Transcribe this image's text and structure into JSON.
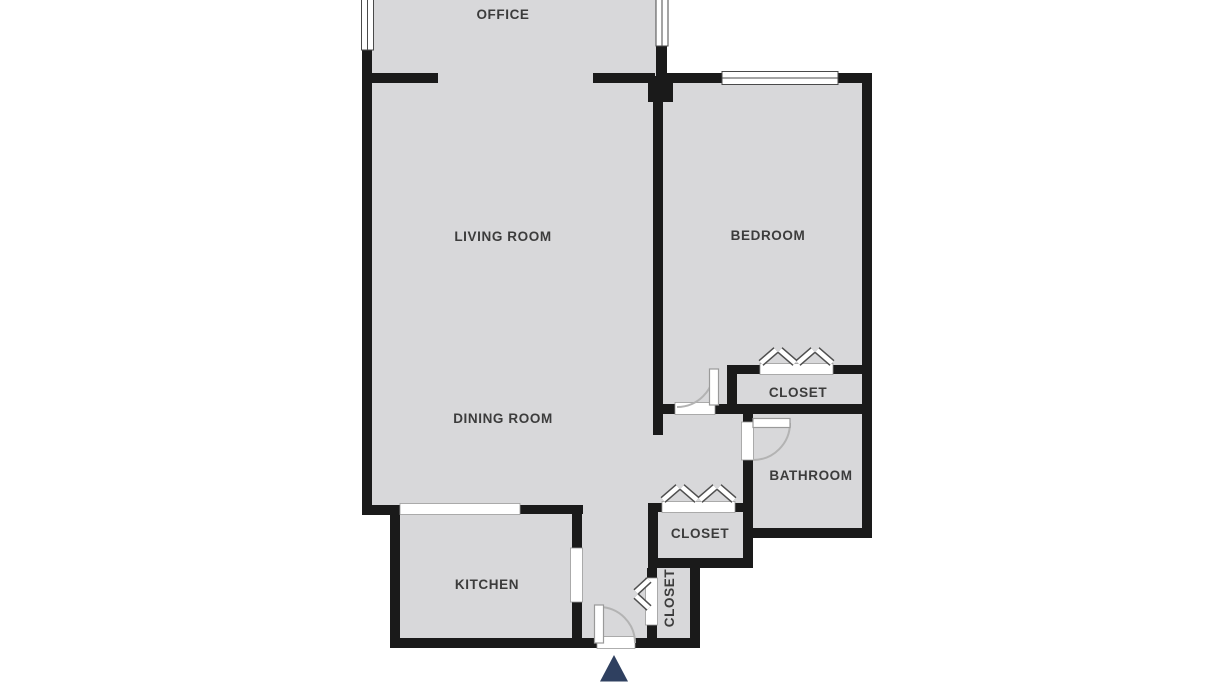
{
  "floorplan": {
    "rooms": [
      {
        "id": "office",
        "label": "OFFICE"
      },
      {
        "id": "living-room",
        "label": "LIVING ROOM"
      },
      {
        "id": "bedroom",
        "label": "BEDROOM"
      },
      {
        "id": "dining-room",
        "label": "DINING ROOM"
      },
      {
        "id": "bedroom-closet",
        "label": "CLOSET"
      },
      {
        "id": "bathroom",
        "label": "BATHROOM"
      },
      {
        "id": "hall-closet",
        "label": "CLOSET"
      },
      {
        "id": "kitchen",
        "label": "KITCHEN"
      },
      {
        "id": "entry-closet",
        "label": "CLOSET"
      }
    ],
    "entrance_marker": "entrance-arrow",
    "colors": {
      "background": "#ffffff",
      "floor": "#d8d8da",
      "wall": "#1a1a1a",
      "label": "#3c3c3c",
      "door-arc": "#b3b3b3",
      "arrow": "#2f4060"
    }
  }
}
